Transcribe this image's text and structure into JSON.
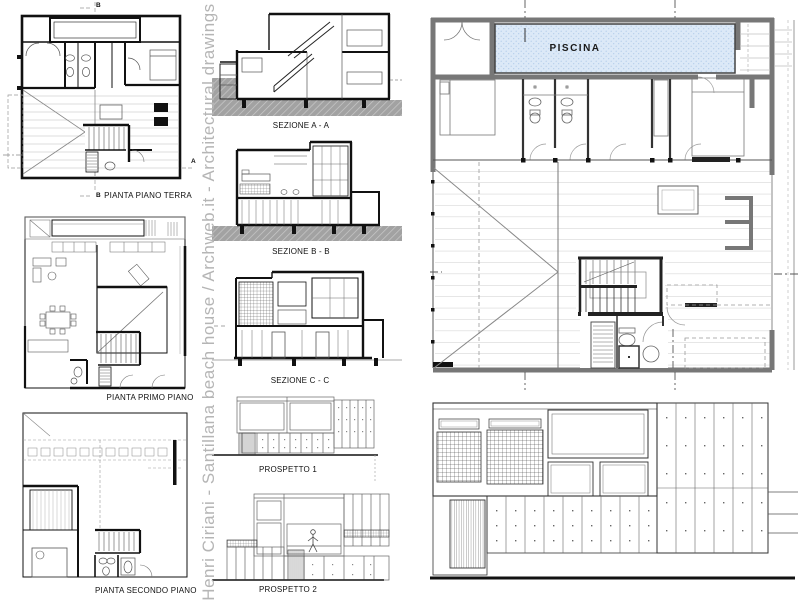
{
  "credit": {
    "text": "Henri Ciriani - Santillana beach house / Archweb.it - Architectural drawings"
  },
  "drawings": {
    "plan_terra": {
      "label": "PIANTA PIANO TERRA"
    },
    "plan_primo": {
      "label": "PIANTA PRIMO PIANO"
    },
    "plan_secondo": {
      "label": "PIANTA SECONDO PIANO"
    },
    "section_a": {
      "label": "SEZIONE A - A"
    },
    "section_b": {
      "label": "SEZIONE B - B"
    },
    "section_c": {
      "label": "SEZIONE C - C"
    },
    "prospetto_1": {
      "label": "PROSPETTO 1"
    },
    "prospetto_2": {
      "label": "PROSPETTO 2"
    },
    "main_plan": {
      "pool_label": "PISCINA"
    }
  },
  "section_marks": {
    "b_top": "B",
    "b_bottom": "B",
    "a_side": "A"
  },
  "colors": {
    "pool_fill": "#dce9f7",
    "pool_dot": "#aec9e8",
    "wall_gray": "#777777",
    "ground_gray": "#a2a2a2",
    "ink": "#1a1a1a",
    "credit_gray": "#b5b5b5"
  }
}
